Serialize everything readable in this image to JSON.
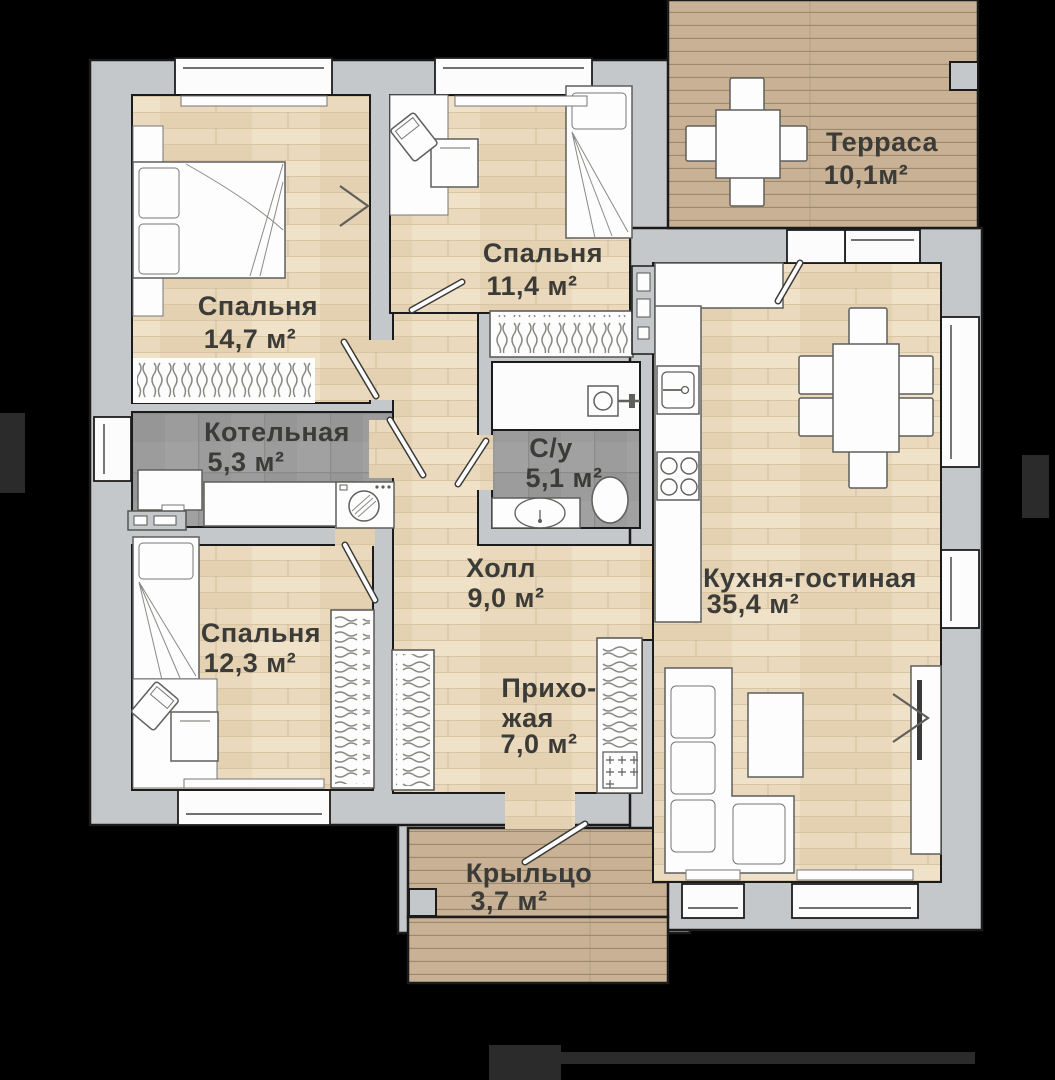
{
  "plan": {
    "colors": {
      "background": "#000000",
      "wall": "#c5c8ca",
      "wood_floor": "#ead9bc",
      "wood_floor_line": "#d8c5a3",
      "deck": "#c8b194",
      "deck_line": "#9d8a6b",
      "tile": "#9c9c9c",
      "label_text": "#3b3b38",
      "furniture_white": "#fdfdfd",
      "outline": "#1b1b1b"
    },
    "rooms": [
      {
        "id": "terrace",
        "name": "Терраса",
        "area": "10,1м²"
      },
      {
        "id": "bedroom-1",
        "name": "Спальня",
        "area": "14,7 м²"
      },
      {
        "id": "bedroom-2",
        "name": "Спальня",
        "area": "11,4 м²"
      },
      {
        "id": "boiler-room",
        "name": "Котельная",
        "area": "5,3 м²"
      },
      {
        "id": "bathroom",
        "name": "С/у",
        "area": "5,1 м²"
      },
      {
        "id": "hall",
        "name": "Холл",
        "area": "9,0 м²"
      },
      {
        "id": "kitchen-living",
        "name": "Кухня-гостиная",
        "area": "35,4 м²"
      },
      {
        "id": "bedroom-3",
        "name": "Спальня",
        "area": "12,3 м²"
      },
      {
        "id": "entry",
        "name_lines": [
          "Прихо-",
          "жая"
        ],
        "area": "7,0 м²"
      },
      {
        "id": "porch",
        "name": "Крыльцо",
        "area": "3,7 м²"
      }
    ]
  }
}
